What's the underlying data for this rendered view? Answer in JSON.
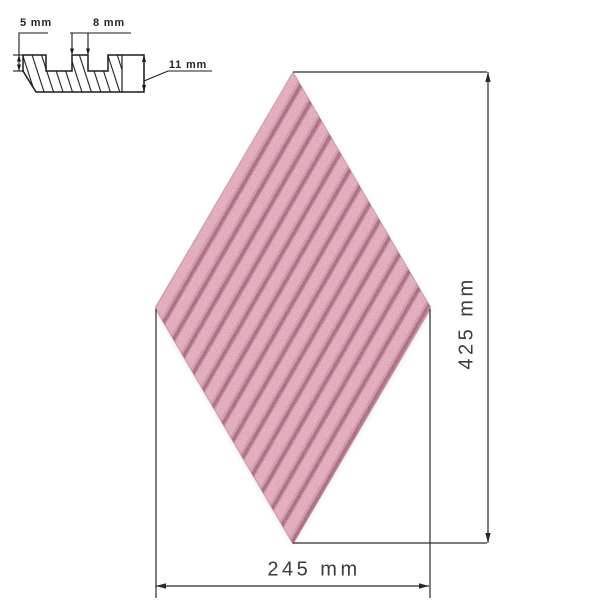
{
  "diagram": {
    "background_color": "#ffffff",
    "drawing_line_color": "#1b1b1b",
    "dimension_line_color": "#2a2a2a",
    "text_color": "#3b3b3b"
  },
  "cross_section": {
    "ridge_height_label": "5 mm",
    "ridge_width_label": "8 mm",
    "panel_thickness_label": "11 mm"
  },
  "tile": {
    "shape": "rhombus",
    "finish": "diagonal-fluted speckled stone",
    "ridge_color": "#e5aebd",
    "groove_color": "#aa6b80",
    "height_label": "425 mm",
    "width_label": "245 mm"
  }
}
